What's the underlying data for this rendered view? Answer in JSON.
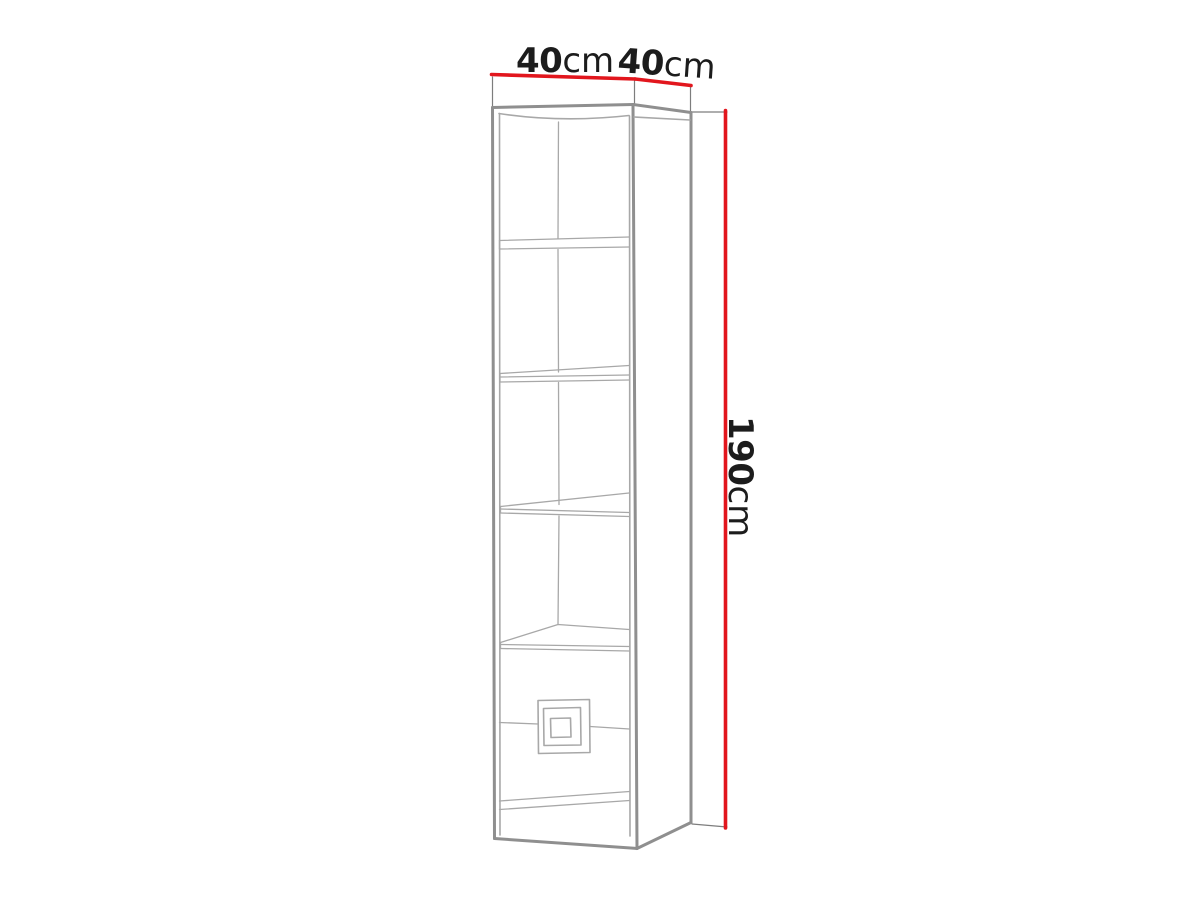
{
  "figure": {
    "kind": "furniture dimension diagram",
    "object": "tall narrow bookcase (line drawing) with four shelves, five openings and a bottom drawer front with a square concentric handle",
    "view": "front-left perspective sketch",
    "shelf_count": 4,
    "drawer_count": 1
  },
  "dimensions": {
    "width": {
      "value": "40",
      "unit": "cm",
      "meaning": "cabinet width, shown above the front face"
    },
    "depth": {
      "value": "40",
      "unit": "cm",
      "meaning": "cabinet depth, shown above the side panel"
    },
    "height": {
      "value": "190",
      "unit": "cm",
      "meaning": "cabinet height, shown rotated along the right side"
    }
  },
  "colors": {
    "background": "#ffffff",
    "dimension_line": "#e2161d",
    "outline_dark": "#8f8f8f",
    "outline_light": "#a8a8a8",
    "extension_line": "#7d7d7d",
    "text": "#1c1c1c"
  }
}
